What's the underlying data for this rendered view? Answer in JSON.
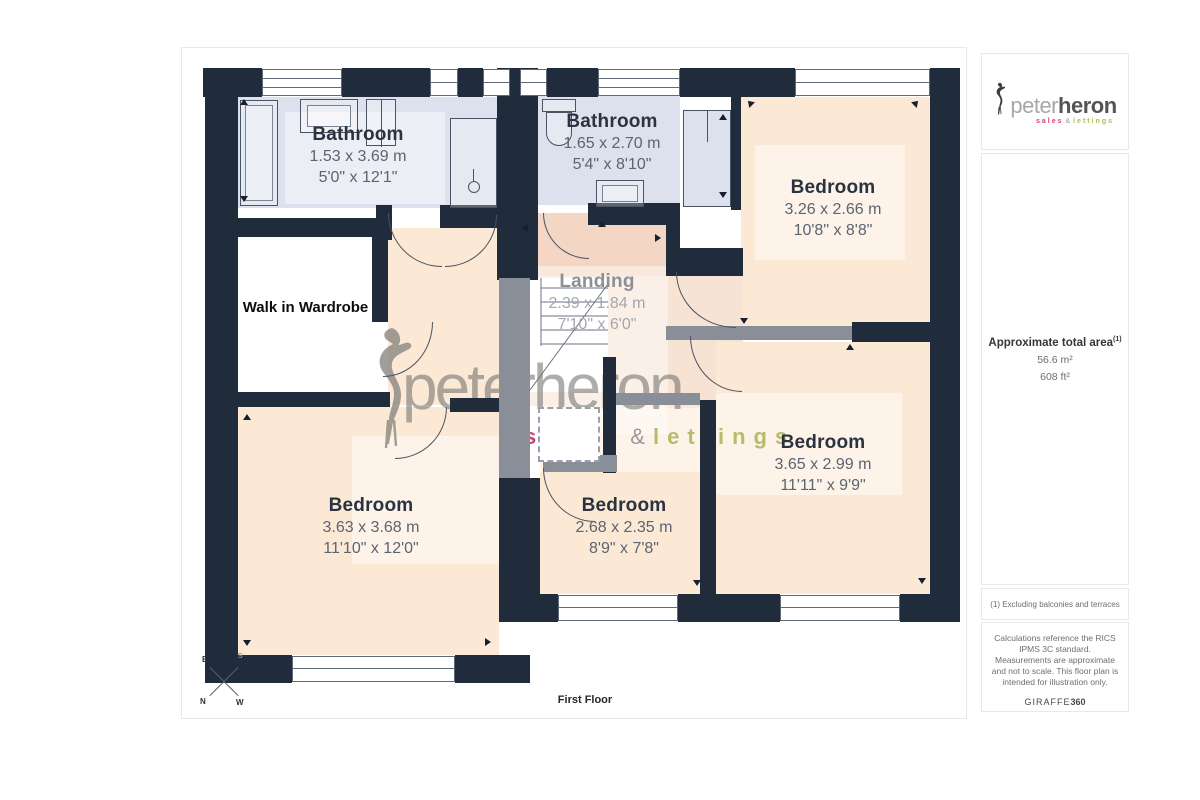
{
  "page": {
    "floor_label": "First Floor"
  },
  "rooms": [
    {
      "name": "Bathroom",
      "metric": "1.53 x 3.69 m",
      "imperial": "5'0\" x 12'1\""
    },
    {
      "name": "Bathroom",
      "metric": "1.65 x 2.70 m",
      "imperial": "5'4\" x 8'10\""
    },
    {
      "name": "Bedroom",
      "metric": "3.26 x 2.66 m",
      "imperial": "10'8\" x 8'8\""
    },
    {
      "name": "Landing",
      "metric": "2.39 x 1.84 m",
      "imperial": "7'10\" x 6'0\""
    },
    {
      "name": "Walk in Wardrobe"
    },
    {
      "name": "Bedroom",
      "metric": "3.63 x 3.68 m",
      "imperial": "11'10\" x 12'0\""
    },
    {
      "name": "Bedroom",
      "metric": "2.68 x 2.35 m",
      "imperial": "8'9\" x 7'8\""
    },
    {
      "name": "Bedroom",
      "metric": "3.65 x 2.99 m",
      "imperial": "11'11\" x 9'9\""
    }
  ],
  "branding": {
    "watermark": {
      "main": "peterheron",
      "sales": "sales",
      "amp": "&",
      "lettings": "lettings"
    },
    "logo": {
      "peter": "peter",
      "heron": "heron",
      "sales": "sales",
      "amp": "&",
      "lettings": "lettings"
    },
    "colors": {
      "wall": "#202c3c",
      "bath_fill": "#dce1ed",
      "bedroom_fill": "#fbe9d6",
      "landing_fill": "#f6e3d4",
      "pink_fill": "#f3d6c3",
      "sales_red": "#d64069",
      "lettings_olive": "#b2b85c"
    }
  },
  "sidebar": {
    "area": {
      "label": "Approximate total area",
      "marker": "(1)",
      "m2": "56.6 m²",
      "ft2": "608 ft²"
    },
    "footnote": "(1) Excluding balconies and terraces",
    "disclaimer": "Calculations reference the RICS IPMS 3C standard. Measurements are approximate and not to scale. This floor plan is intended for illustration only.",
    "provider": {
      "name": "GIRAFFE",
      "suffix": "360"
    }
  },
  "compass": {
    "n": "N",
    "e": "E",
    "s": "S",
    "w": "W"
  }
}
